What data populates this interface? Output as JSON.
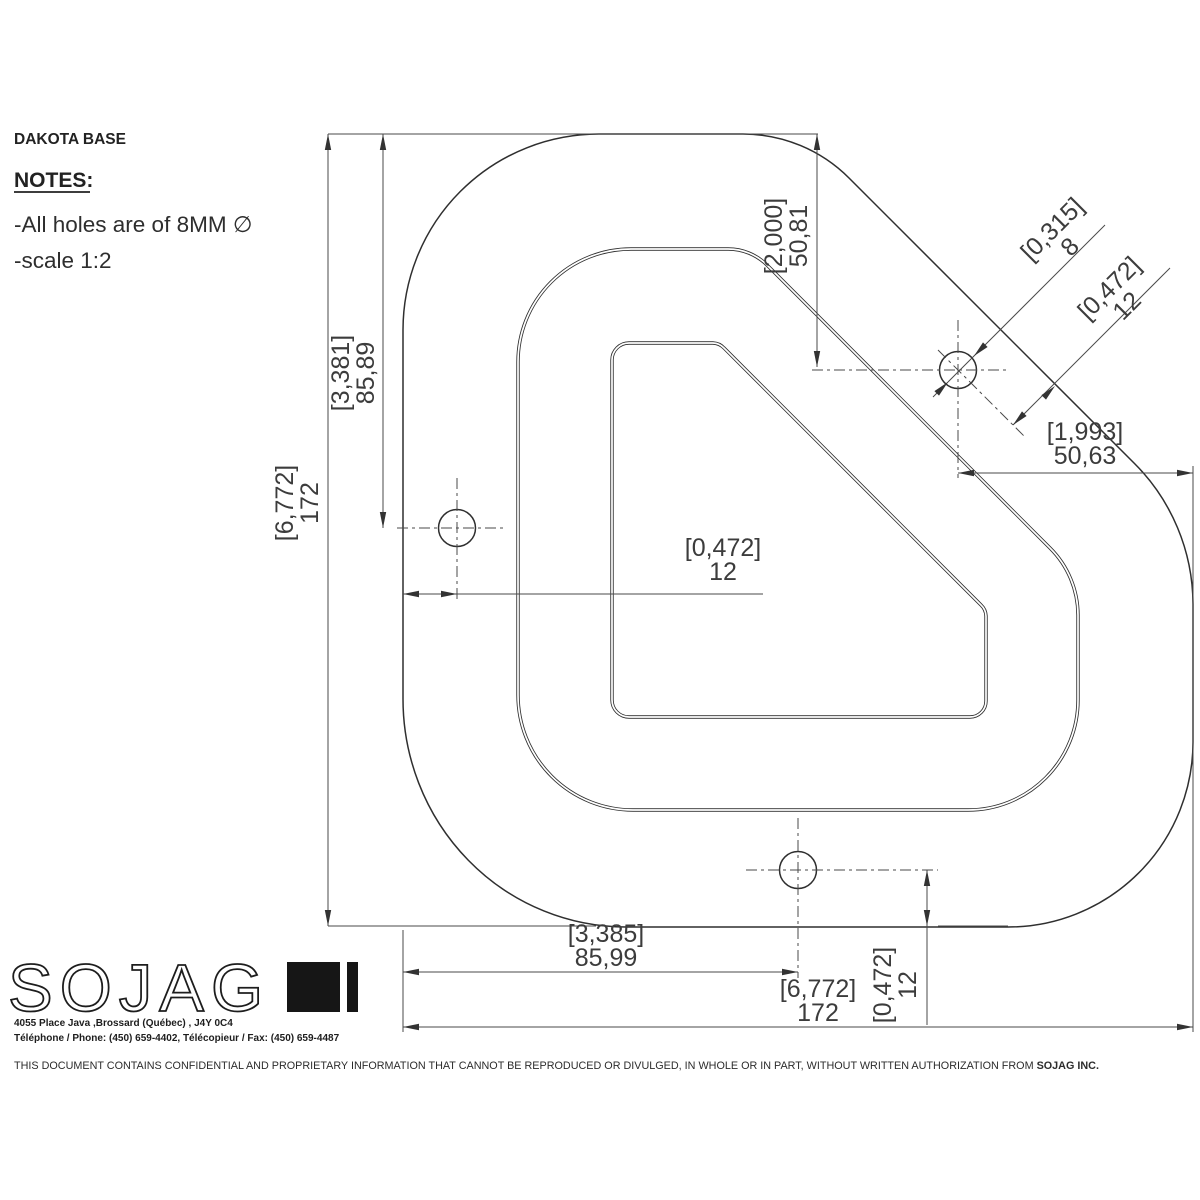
{
  "title": "DAKOTA BASE",
  "notes": {
    "heading": "NOTES:",
    "item_holes": "-All holes are of 8MM ∅",
    "item_scale": "-scale 1:2"
  },
  "dimensions": {
    "overall_height": {
      "bracket": "[6,772]",
      "value": "172"
    },
    "left_hole_from_top": {
      "bracket": "[3,381]",
      "value": "85,89"
    },
    "top_hole_from_top": {
      "bracket": "[2,000]",
      "value": "50,81"
    },
    "hole_diameter": {
      "bracket": "[0,315]",
      "value": "8"
    },
    "top_hole_edge_offset": {
      "bracket": "[0,472]",
      "value": "12"
    },
    "top_hole_from_right": {
      "bracket": "[1,993]",
      "value": "50,63"
    },
    "left_hole_from_edge": {
      "bracket": "[0,472]",
      "value": "12"
    },
    "bottom_hole_from_left": {
      "bracket": "[3,385]",
      "value": "85,99"
    },
    "overall_width": {
      "bracket": "[6,772]",
      "value": "172"
    },
    "bottom_hole_from_edge": {
      "bracket": "[0,472]",
      "value": "12"
    }
  },
  "logo": {
    "text": "SOJAG"
  },
  "company": {
    "address": "4055 Place Java ,Brossard (Québec) , J4Y 0C4",
    "phone_fax": "Téléphone / Phone: (450) 659-4402, Télécopieur / Fax: (450) 659-4487"
  },
  "footer": {
    "text": "THIS DOCUMENT CONTAINS CONFIDENTIAL AND PROPRIETARY INFORMATION THAT CANNOT BE REPRODUCED OR DIVULGED, IN WHOLE OR IN PART, WITHOUT WRITTEN AUTHORIZATION FROM ",
    "bold": "SOJAG INC."
  },
  "colors": {
    "line": "#2f2f2f",
    "dim": "#4a4a4a",
    "text": "#3c3c3c"
  }
}
